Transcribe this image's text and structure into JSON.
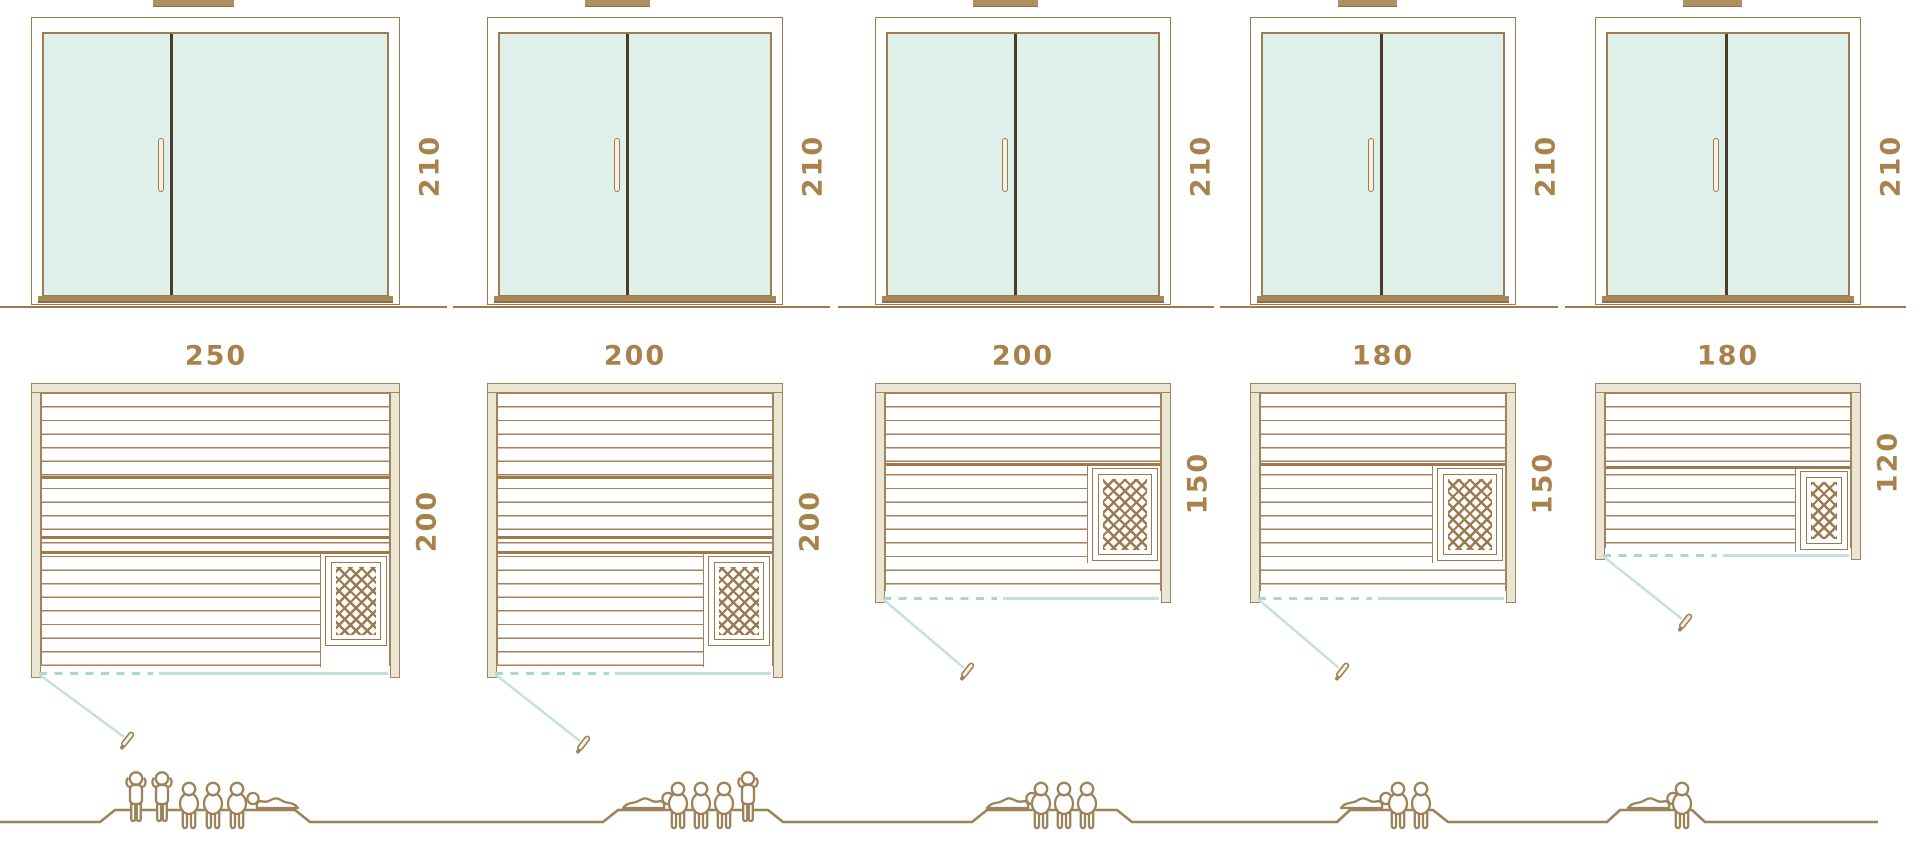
{
  "diagram_title": "sauna-size-comparison-diagram",
  "models": [
    {
      "width_cm": "250",
      "depth_cm": "200",
      "height_cm": "210",
      "people": [
        "standing",
        "standing",
        "sitting",
        "sitting",
        "sitting",
        "lying"
      ]
    },
    {
      "width_cm": "200",
      "depth_cm": "200",
      "height_cm": "210",
      "people": [
        "lying",
        "sitting",
        "sitting",
        "sitting",
        "standing"
      ]
    },
    {
      "width_cm": "200",
      "depth_cm": "150",
      "height_cm": "210",
      "people": [
        "lying",
        "sitting",
        "sitting",
        "sitting"
      ]
    },
    {
      "width_cm": "180",
      "depth_cm": "150",
      "height_cm": "210",
      "people": [
        "lying",
        "sitting",
        "sitting"
      ]
    },
    {
      "width_cm": "180",
      "depth_cm": "120",
      "height_cm": "210",
      "people": [
        "lying",
        "sitting"
      ]
    }
  ],
  "colors": {
    "outline_brown": "#A0794A",
    "slat_brown": "#A5825A",
    "dark_brown": "#4A3B2A",
    "wall_beige": "#E9E7D4",
    "glass_mint": "#DFF0EA",
    "teal_line": "#C3E1DA",
    "teal_dash": "#AFD6CD",
    "dimension_text": "#A8824B",
    "people_brown": "#9C8258",
    "heater_brown": "#9C7A4E",
    "threshold_brown": "#A88756",
    "chimney_brown": "#AD8F62",
    "handle_fill": "#F6F0E6"
  }
}
